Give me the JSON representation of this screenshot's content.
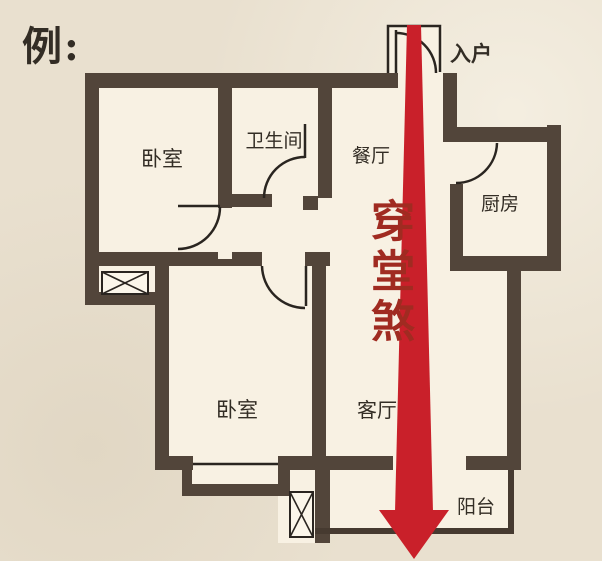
{
  "title": "例:",
  "entry_label": "入户",
  "annotation": "穿堂煞",
  "rooms": {
    "bedroom_top": "卧室",
    "bathroom": "卫生间",
    "dining": "餐厅",
    "kitchen": "厨房",
    "bedroom_bottom": "卧室",
    "living": "客厅",
    "balcony": "阳台"
  },
  "colors": {
    "background": "#e9e0cf",
    "floor": "#f8f1e3",
    "wall": "#52453a",
    "line": "#2a2520",
    "arrow_red": "#c9202a",
    "annotation_red": "#a02b21",
    "text_dark": "#332d25"
  }
}
